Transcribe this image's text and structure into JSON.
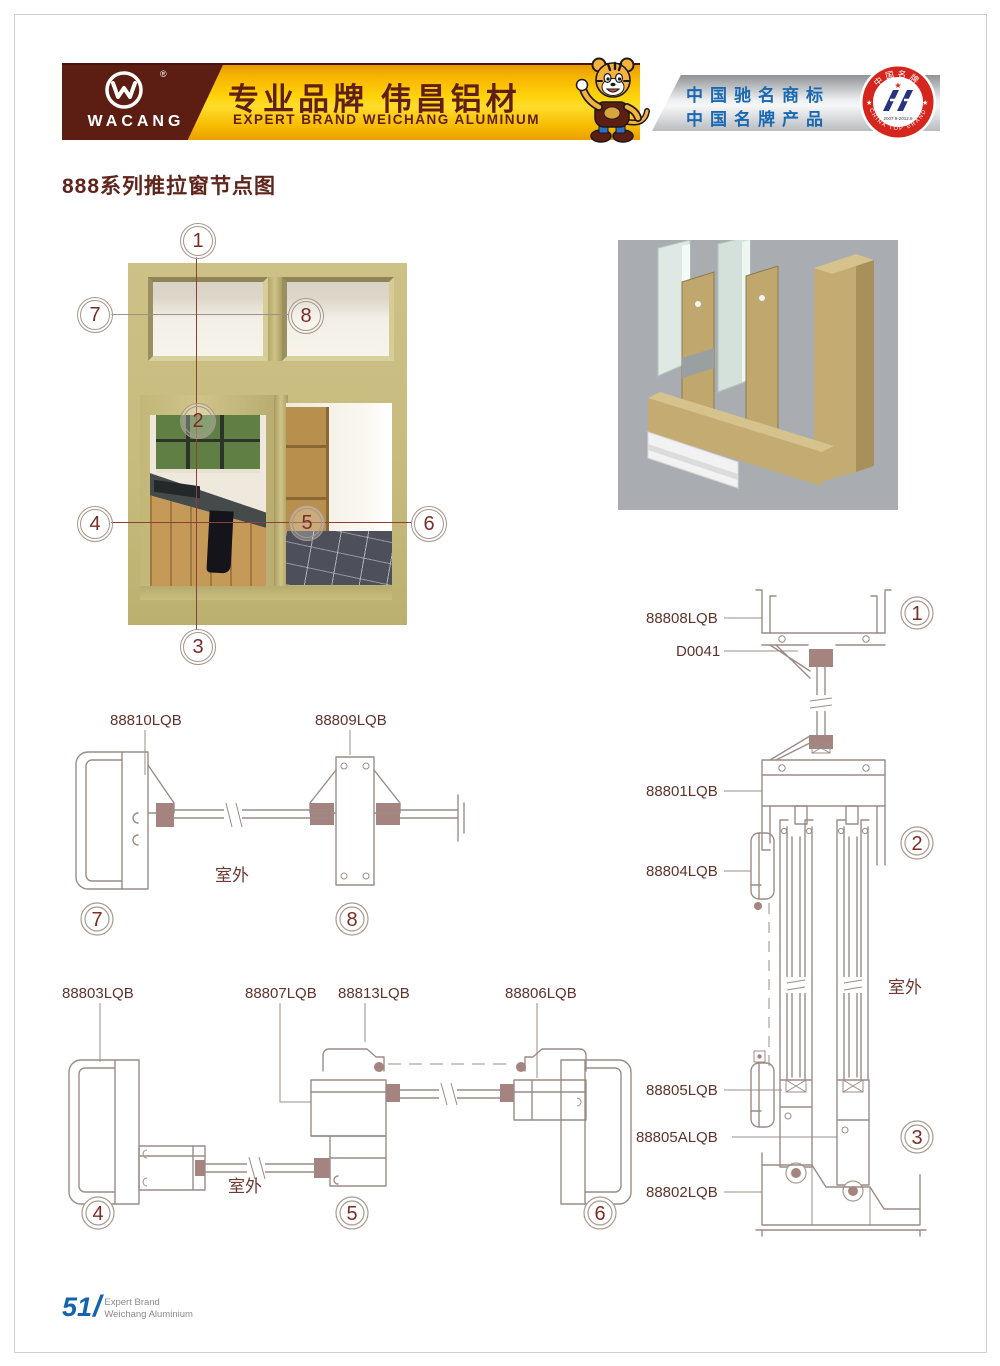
{
  "page": {
    "title": "888系列推拉窗节点图"
  },
  "header": {
    "brand": "WACANG",
    "registered": "®",
    "slogan_cn": "专业品牌  伟昌铝材",
    "slogan_en": "EXPERT BRAND WEICHANG ALUMINUM",
    "honor_line1": "中国驰名商标",
    "honor_line2": "中国名牌产品",
    "badge_top": "中国名牌",
    "badge_bottom": "CHINA TOP BRAND",
    "badge_dates": "2007.9-2012.9",
    "badge_star_left": "★",
    "badge_star_right": "★"
  },
  "photo": {
    "callouts": [
      "1",
      "2",
      "3",
      "4",
      "5",
      "6",
      "7",
      "8"
    ]
  },
  "diagrams": {
    "transom": {
      "label_left": "88810LQB",
      "label_right": "88809LQB",
      "outdoor": "室外",
      "node_left": "7",
      "node_right": "8"
    },
    "horizontal": {
      "label_1": "88803LQB",
      "label_2": "88807LQB",
      "label_3": "88813LQB",
      "label_4": "88806LQB",
      "outdoor": "室外",
      "node_1": "4",
      "node_2": "5",
      "node_3": "6"
    },
    "vertical": {
      "label_1": "88808LQB",
      "label_2": "D0041",
      "label_3": "88801LQB",
      "label_4": "88804LQB",
      "label_5": "88805LQB",
      "label_6": "88805ALQB",
      "label_7": "88802LQB",
      "outdoor": "室外",
      "node_1": "1",
      "node_2": "2",
      "node_3": "3"
    }
  },
  "footer": {
    "page_number": "51",
    "divider": "/",
    "line1": "Expert Brand",
    "line2": "Weichang Aluminium"
  },
  "colors": {
    "brand_maroon": "#5c1d12",
    "banner_yellow": "#ffd30a",
    "honor_blue": "#1a68b2",
    "badge_red": "#d6251d",
    "cad_line": "#9b8c86",
    "frame_khaki": "#c6ba7e",
    "label_text": "#5e342c"
  }
}
